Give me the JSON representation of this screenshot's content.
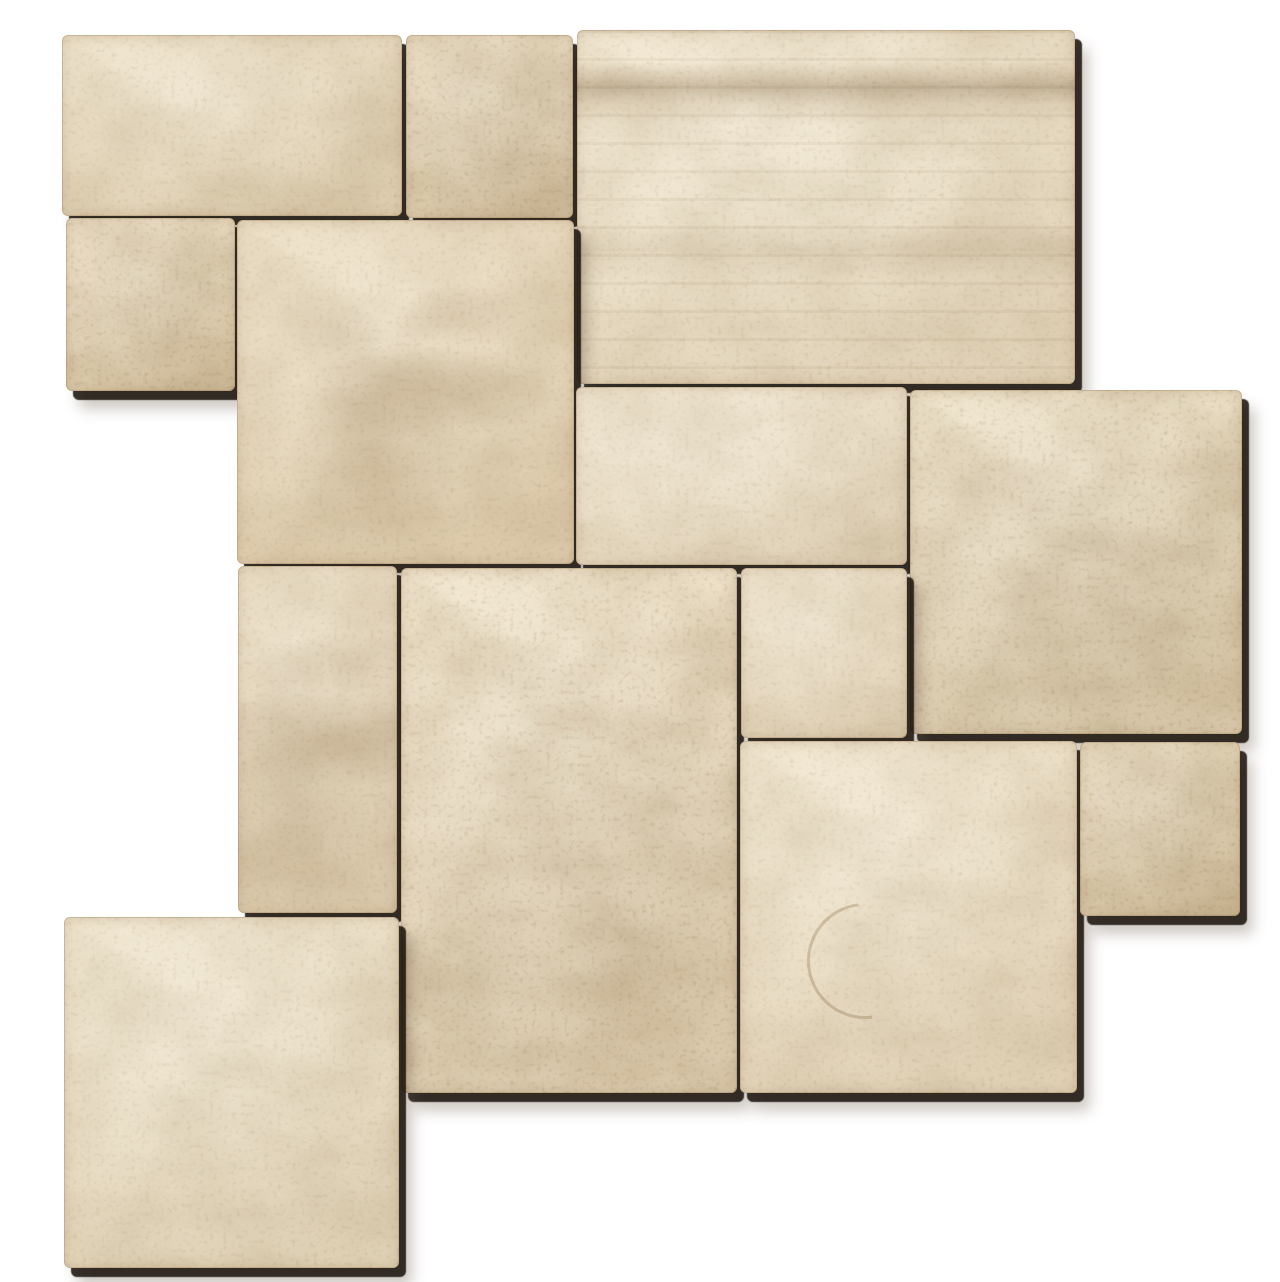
{
  "scene": {
    "description": "Beige travertine stone tiles laid loose in a French Versailles pattern, photographed from above on a white background with hard drop shadows falling to the lower right",
    "background_color": "#ffffff",
    "stone_cream_light": "#ecdfc5",
    "stone_cream_mid": "#e7d8ba",
    "stone_cream_dark": "#e3d3b3",
    "vein_brown": "#a9855a",
    "pore_brown": "#4a3820",
    "seam_shadow": "#1c130a",
    "tile_count": 13
  },
  "tiles": [
    {
      "id": 1,
      "name": "rect-16x8-top-left",
      "x": 62,
      "y": 35,
      "w": 340,
      "h": 181,
      "base": "#e8d9bc",
      "variant": "plain"
    },
    {
      "id": 2,
      "name": "square-8x8-top",
      "x": 406,
      "y": 35,
      "w": 167,
      "h": 183,
      "base": "#e6d6b8",
      "variant": "rough"
    },
    {
      "id": 3,
      "name": "rect-24x16-top-right",
      "x": 577,
      "y": 30,
      "w": 498,
      "h": 354,
      "base": "#ecdfc5",
      "variant": "banded"
    },
    {
      "id": 4,
      "name": "square-8x8-left",
      "x": 66,
      "y": 218,
      "w": 169,
      "h": 173,
      "base": "#e7d7b8",
      "variant": "rough"
    },
    {
      "id": 5,
      "name": "square-16x16-upper-middle",
      "x": 237,
      "y": 220,
      "w": 337,
      "h": 344,
      "base": "#e6d5b6",
      "variant": "veined"
    },
    {
      "id": 6,
      "name": "rect-16x8-middle",
      "x": 576,
      "y": 387,
      "w": 331,
      "h": 178,
      "base": "#ecdfc6",
      "variant": "plain"
    },
    {
      "id": 7,
      "name": "square-16x16-middle-right",
      "x": 910,
      "y": 390,
      "w": 332,
      "h": 344,
      "base": "#e8dabd",
      "variant": "rough"
    },
    {
      "id": 8,
      "name": "rect-8x16-middle-left",
      "x": 238,
      "y": 566,
      "w": 159,
      "h": 347,
      "base": "#e6d6b9",
      "variant": "veined"
    },
    {
      "id": 9,
      "name": "rect-16x24-center",
      "x": 401,
      "y": 568,
      "w": 336,
      "h": 525,
      "base": "#ebdcc0",
      "variant": "rough"
    },
    {
      "id": 10,
      "name": "square-8x8-center",
      "x": 741,
      "y": 568,
      "w": 166,
      "h": 170,
      "base": "#ecdec4",
      "variant": "plain"
    },
    {
      "id": 11,
      "name": "square-16x16-bottom-right",
      "x": 740,
      "y": 741,
      "w": 337,
      "h": 352,
      "base": "#ebddc2",
      "variant": "crescent"
    },
    {
      "id": 12,
      "name": "square-8x8-right",
      "x": 1080,
      "y": 742,
      "w": 160,
      "h": 174,
      "base": "#e3d3b3",
      "variant": "rough"
    },
    {
      "id": 13,
      "name": "square-16x16-bottom-left",
      "x": 64,
      "y": 917,
      "w": 335,
      "h": 351,
      "base": "#eaddc2",
      "variant": "plain"
    }
  ]
}
